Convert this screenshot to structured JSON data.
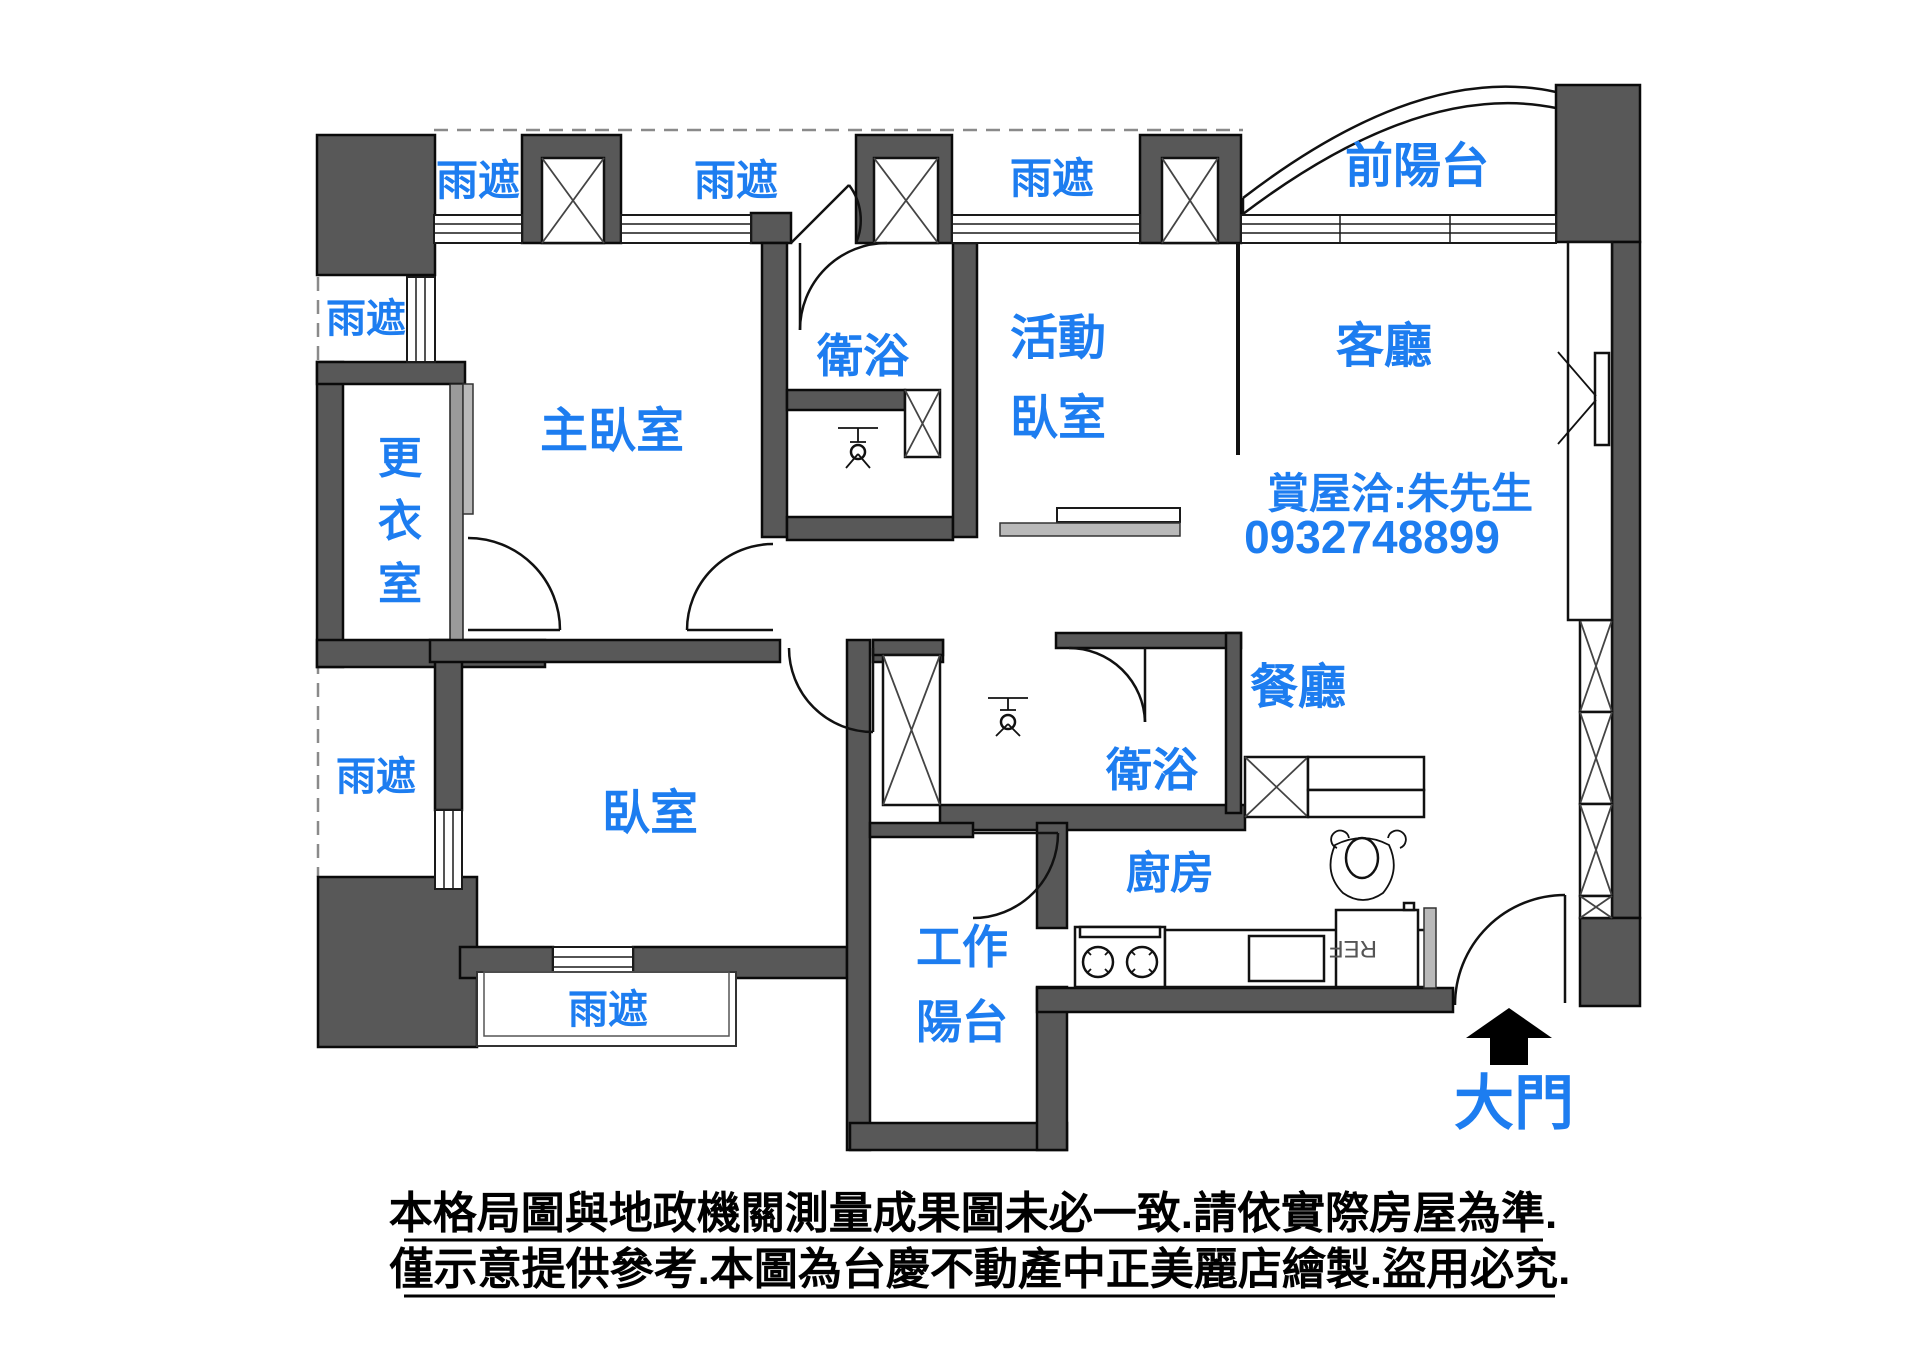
{
  "colors": {
    "label_blue": "#1d7df0",
    "wall_gray": "#585858",
    "text_black": "#000000",
    "background": "#ffffff"
  },
  "canopy_labels": {
    "top_left": "雨遮",
    "top_mid": "雨遮",
    "top_right": "雨遮",
    "left_upper": "雨遮",
    "left_lower": "雨遮",
    "bottom": "雨遮"
  },
  "rooms": {
    "front_balcony": "前陽台",
    "living": "客廳",
    "dining": "餐廳",
    "kitchen": "廚房",
    "master_bedroom": "主臥室",
    "bedroom": "臥室",
    "bath_top": "衛浴",
    "bath_bottom": "衛浴",
    "flex_bedroom_line1": "活動",
    "flex_bedroom_line2": "臥室",
    "work_balcony_line1": "工作",
    "work_balcony_line2": "陽台",
    "main_door": "大門",
    "dressing_chars": [
      "更",
      "衣",
      "室"
    ]
  },
  "contact": {
    "line1": "賞屋洽:朱先生",
    "line2": "0932748899"
  },
  "appliances": {
    "fridge": "REF"
  },
  "disclaimer": {
    "line1": "本格局圖與地政機關測量成果圖未必一致.請依實際房屋為準.",
    "line2": "僅示意提供參考.本圖為台慶不動產中正美麗店繪製.盜用必究."
  }
}
